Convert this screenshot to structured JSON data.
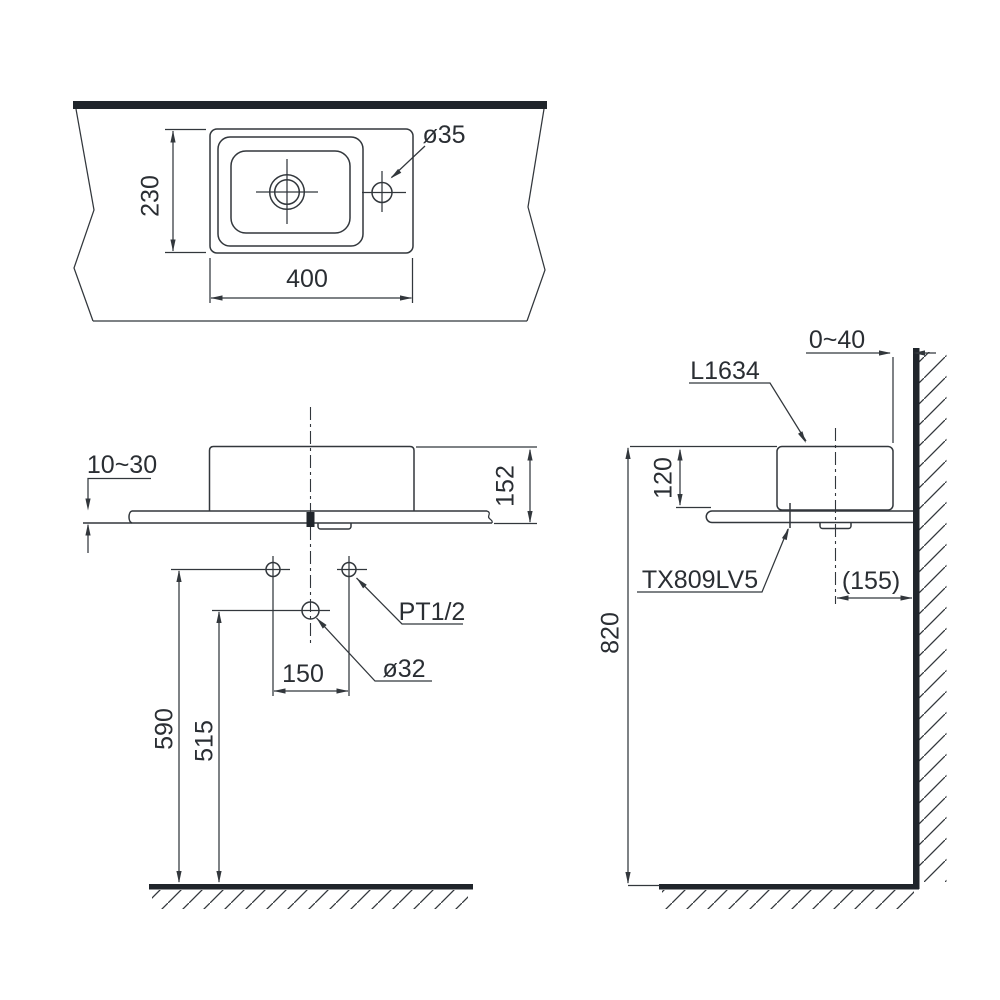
{
  "colors": {
    "line": "#32373c",
    "text": "#2a2e33",
    "background": "#ffffff"
  },
  "top_view": {
    "depth_mm": "230",
    "width_mm": "400",
    "faucet_hole_dia": "ø35"
  },
  "front_view": {
    "counter_thickness": "10~30",
    "rim_height_above_counter": "152",
    "supply_spacing": "150",
    "supply_thread": "PT1/2",
    "drain_dia": "ø32",
    "supply_height_from_floor": "590",
    "drain_height_from_floor": "515"
  },
  "side_view": {
    "wall_clearance": "0~40",
    "basin_model": "L1634",
    "basin_height": "120",
    "faucet_model": "TX809LV5",
    "drain_center_to_wall": "(155)",
    "counter_height_from_floor": "820"
  }
}
